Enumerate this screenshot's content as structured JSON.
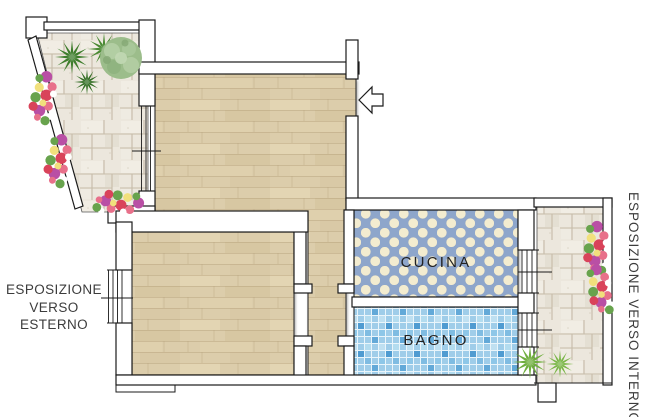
{
  "labels": {
    "kitchen": "CUCINA",
    "bathroom": "BAGNO"
  },
  "exposure_left": {
    "line1": "ESPOSIZIONE",
    "line2": "VERSO",
    "line3": "ESTERNO"
  },
  "exposure_right": "ESPOSIZIONE VERSO INTERNO",
  "colors": {
    "wood": "#dccdab",
    "stone": "#ece7dd",
    "kitchen_tile": "#8ea6cb",
    "kitchen_dot": "#f3ecd0",
    "bath_tile": "#9fcde9",
    "wall_fill": "#ffffff",
    "outline": "#1b1b1b",
    "label_text": "#222222",
    "annotation_text": "#3c3c3c"
  }
}
